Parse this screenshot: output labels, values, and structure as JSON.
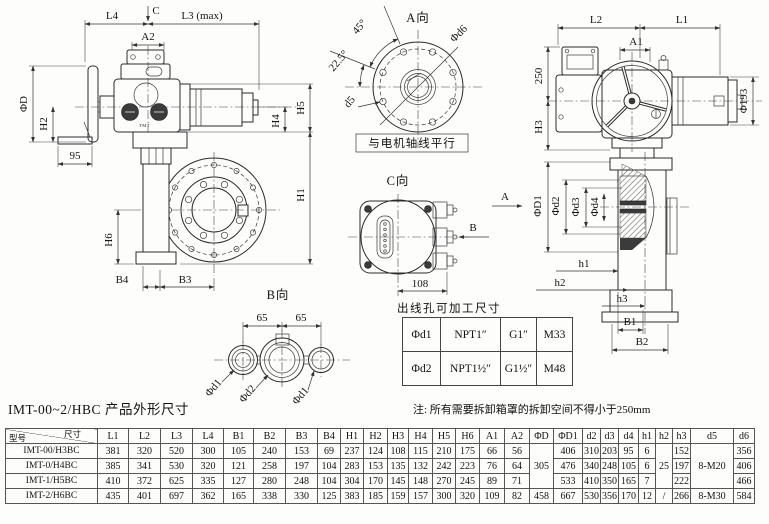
{
  "title": "IMT-00~2/HBC 产品外形尺寸",
  "note": "注: 所有需要拆卸箱罩的拆卸空间不得小于250mm",
  "drawing": {
    "side_view": {
      "L4": "L4",
      "C": "C",
      "L3max": "L3 (max)",
      "A2": "A2",
      "phiD": "ΦD",
      "H2": "H2",
      "n95": "95",
      "H5": "H5",
      "H4": "H4",
      "H1": "H1",
      "H6": "H6",
      "B4": "B4",
      "B3": "B3",
      "brand": "TMT"
    },
    "a_view": {
      "title": "A向",
      "deg45": "45°",
      "deg22_5": "22.5°",
      "phid6": "Φd6",
      "d5": "d5",
      "note": "与电机轴线平行"
    },
    "front_view": {
      "L2": "L2",
      "L1": "L1",
      "A1": "A1",
      "n250": "250",
      "H3": "H3",
      "phi193": "Φ193"
    },
    "section_view": {
      "phiD1": "ΦD1",
      "phid2": "Φd2",
      "phid3": "Φd3",
      "phid4": "Φd4",
      "h1": "h1",
      "h2": "h2",
      "h3": "h3",
      "B1": "B1",
      "B2": "B2"
    },
    "c_view": {
      "title": "C向",
      "n108": "108",
      "dirA": "A",
      "dirB": "B"
    },
    "b_view": {
      "title": "B向",
      "n65a": "65",
      "n65b": "65",
      "phid1a": "Φd1",
      "phid2": "Φd2",
      "phid1b": "Φd1"
    }
  },
  "outlet_table": {
    "caption": "出线孔可加工尺寸",
    "rows": [
      [
        "Φd1",
        "NPT1″",
        "G1″",
        "M33"
      ],
      [
        "Φd2",
        "NPT1½″",
        "G1½″",
        "M48"
      ]
    ]
  },
  "dim_table": {
    "corner": {
      "top": "尺寸",
      "bottom": "型号"
    },
    "columns": [
      "L1",
      "L2",
      "L3",
      "L4",
      "B1",
      "B2",
      "B3",
      "B4",
      "H1",
      "H2",
      "H3",
      "H4",
      "H5",
      "H6",
      "A1",
      "A2",
      "ΦD",
      "ΦD1",
      "d2",
      "d3",
      "d4",
      "h1",
      "h2",
      "h3",
      "d5",
      "d6"
    ],
    "rows": [
      {
        "model": "IMT-00/H3BC",
        "cells": [
          "381",
          "320",
          "520",
          "300",
          "105",
          "240",
          "153",
          "69",
          "237",
          "124",
          "108",
          "115",
          "210",
          "175",
          "66",
          "56",
          {
            "v": "305",
            "rowspan": 3
          },
          "406",
          "310",
          "203",
          "95",
          "6",
          {
            "v": "25",
            "rowspan": 3
          },
          "152",
          {
            "v": "8-M20",
            "rowspan": 3
          },
          "356"
        ]
      },
      {
        "model": "IMT-0/H4BC",
        "cells": [
          "385",
          "341",
          "530",
          "320",
          "121",
          "258",
          "197",
          "104",
          "283",
          "153",
          "135",
          "132",
          "242",
          "223",
          "76",
          "64",
          "476",
          "340",
          "248",
          "105",
          "6",
          "197",
          "406"
        ]
      },
      {
        "model": "IMT-1/H5BC",
        "cells": [
          "410",
          "372",
          "625",
          "335",
          "127",
          "280",
          "248",
          "104",
          "304",
          "170",
          "145",
          "148",
          "270",
          "245",
          "89",
          "71",
          "533",
          "410",
          "350",
          "165",
          "7",
          "222",
          "466"
        ]
      },
      {
        "model": "IMT-2/H6BC",
        "cells": [
          "435",
          "401",
          "697",
          "362",
          "165",
          "338",
          "330",
          "125",
          "383",
          "185",
          "159",
          "157",
          "300",
          "320",
          "109",
          "82",
          "458",
          "667",
          "530",
          "356",
          "170",
          "12",
          "/",
          "266",
          "8-M30",
          "584"
        ]
      }
    ]
  }
}
